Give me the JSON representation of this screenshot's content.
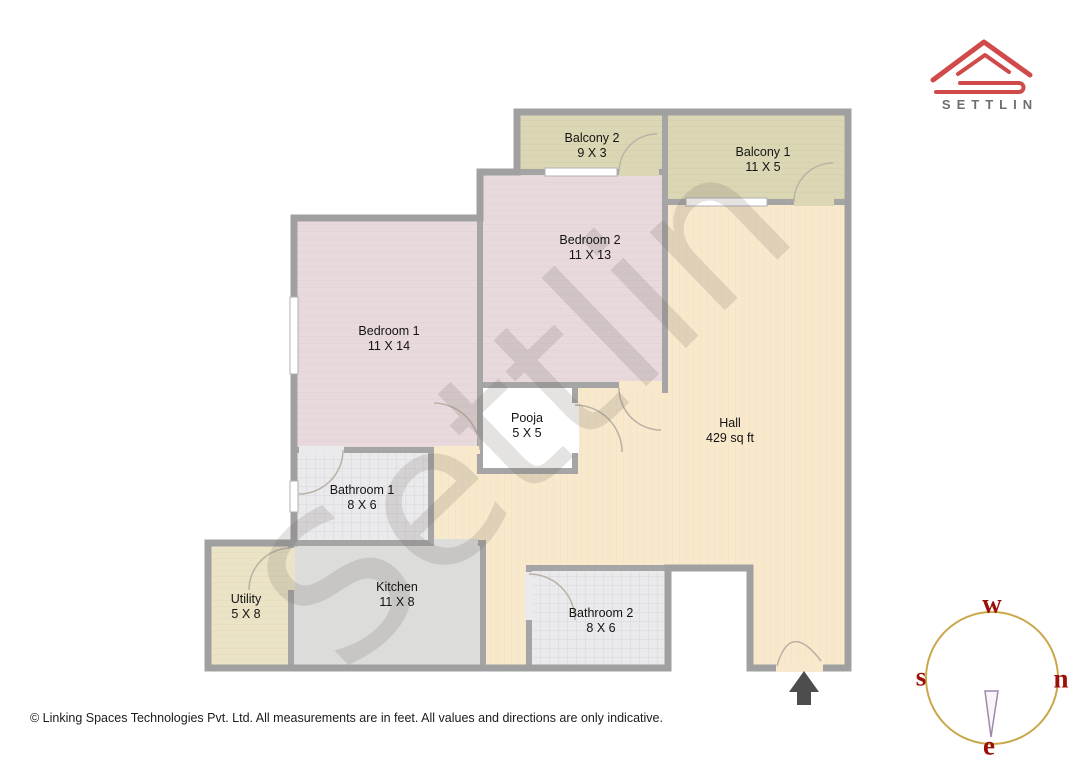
{
  "brand": {
    "name": "SETTLIN"
  },
  "watermark": {
    "text": "Settlin"
  },
  "rooms": [
    {
      "id": "balcony2",
      "name": "Balcony 2",
      "dims": "9 X 3"
    },
    {
      "id": "balcony1",
      "name": "Balcony 1",
      "dims": "11 X 5"
    },
    {
      "id": "bedroom2",
      "name": "Bedroom 2",
      "dims": "11 X 13"
    },
    {
      "id": "bedroom1",
      "name": "Bedroom 1",
      "dims": "11 X 14"
    },
    {
      "id": "pooja",
      "name": "Pooja",
      "dims": "5 X 5"
    },
    {
      "id": "hall",
      "name": "Hall",
      "dims": "429 sq ft"
    },
    {
      "id": "bathroom1",
      "name": "Bathroom 1",
      "dims": "8 X 6"
    },
    {
      "id": "kitchen",
      "name": "Kitchen",
      "dims": "11 X 8"
    },
    {
      "id": "utility",
      "name": "Utility",
      "dims": "5 X 8"
    },
    {
      "id": "bathroom2",
      "name": "Bathroom 2",
      "dims": "8 X 6"
    }
  ],
  "compass": {
    "west": "w",
    "south": "s",
    "north": "n",
    "east": "e"
  },
  "footer": {
    "text": "© Linking Spaces Technologies Pvt. Ltd. All measurements are in feet. All values and directions are only indicative."
  },
  "colors": {
    "wall": "#a5a5a5",
    "hall": "#f8e8cc",
    "bedroom": "#e7d9dc",
    "balcony": "#dbd7b5",
    "bathroom": "#eaeaec",
    "kitchen": "#dcdcda",
    "utility": "#ebe3c6",
    "pooja": "#ffffff",
    "logo_red": "#d14a4a",
    "brand_text": "#6e6e6e",
    "compass_circle": "#c9a84c",
    "compass_letters": "#9b1006",
    "entrance_arrow": "#4d4d4d"
  }
}
